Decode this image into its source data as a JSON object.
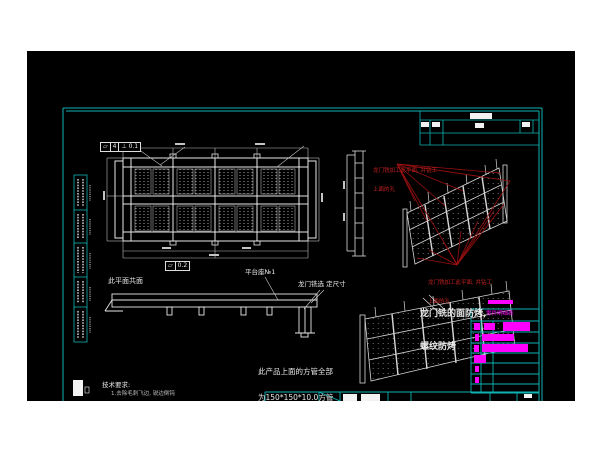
{
  "colors": {
    "canvas_bg": "#000000",
    "page_bg": "#ffffff",
    "frame_cyan": "#0fb3b3",
    "linework_white": "#e8e8e8",
    "annotation_red": "#c62121",
    "leader_red": "#9b1010",
    "highlight_magenta": "#ff00ff"
  },
  "annotations": {
    "gdt_top": {
      "cells": [
        "▱",
        "4",
        "⊥ 0.1"
      ]
    },
    "gdt_bottom": {
      "cells": [
        "▱",
        "0.2"
      ]
    },
    "coplanar_note": "此平面共面",
    "platform_label": "平台座№1",
    "mill_size_note": "龙门铣选 定尺寸",
    "red_note_1": {
      "line1": "龙门铣加工此平面, 并钻工",
      "line2": "上面的孔"
    },
    "red_note_2": {
      "line1": "龙门铣加工此平面, 并钻工",
      "line2": "上面的孔"
    },
    "face_note": {
      "line1": "龙门铣的面防烤,",
      "line2": "螺纹防烤"
    },
    "tube_note": {
      "line1": "此产品上面的方管全部",
      "line2": "为150*150*10.0方管"
    },
    "tech_req": {
      "title": "技术要求:",
      "item1": "1.去除毛刺飞边, 锐边倒钝"
    }
  },
  "bom": {
    "header": "零件明细表"
  }
}
